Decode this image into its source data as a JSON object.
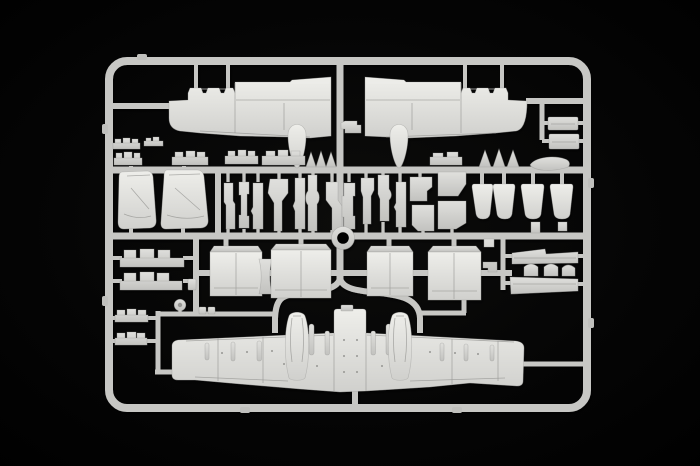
{
  "scene": {
    "type": "photograph",
    "description": "Injection-moulded light grey plastic model kit sprue (runner frame) holding aircraft parts of a twin-engine jet model, photographed on a plain black background",
    "background": "black studio backdrop",
    "visible_text": "none"
  },
  "colors": {
    "background": "#020202",
    "vignette": "#0d0d0c",
    "runner": "#c7c7c4",
    "plastic": "#d6d6d3",
    "plastic-bright": "#efefec",
    "plastic-shadow": "#969693",
    "detail-dark": "#6f6f6d"
  },
  "parts": {
    "frame": "rectangular sprue frame with rounded corners",
    "upper_wing_left": "left upper wing half with wheel-pod fairing",
    "upper_wing_right": "right upper wing half with wheel-pod fairing",
    "lower_wing": "one-piece lower wing with centre fuselage section and twin main-gear pod fairings",
    "gear_pod_left": "left main landing-gear pod fairing",
    "gear_pod_right": "right main landing-gear pod fairing",
    "fin_left": "left vertical stabilizer (tail fin)",
    "fin_right": "right vertical stabilizer (tail fin)",
    "nacelle_1": "engine nacelle half shell 1",
    "nacelle_2": "engine nacelle half shell 2",
    "nacelle_3": "engine nacelle half shell 3",
    "nacelle_4": "engine nacelle half shell 4",
    "exhaust_cones": "four engine intake/exhaust cone parts",
    "gear_strut_row": "row of landing-gear legs, doors and small struts",
    "actuator_fairings_rows": "rows of small elongated actuator-fairing parts",
    "slat_tracks_left": "stacked slat/flap track parts on left edge",
    "flap_sections_right": "two slatted flap sections with hump connectors",
    "avionics_rectangles": "two rectangular bay parts at upper right",
    "small_cone_parts": "small triangular cone parts",
    "blade_antenna_part": "elongated streamlined fairing part",
    "wheel": "small round wheel part",
    "ring_part": "circular ring part at sprue centre",
    "center_link_part": "small notched part between the upper wings"
  }
}
